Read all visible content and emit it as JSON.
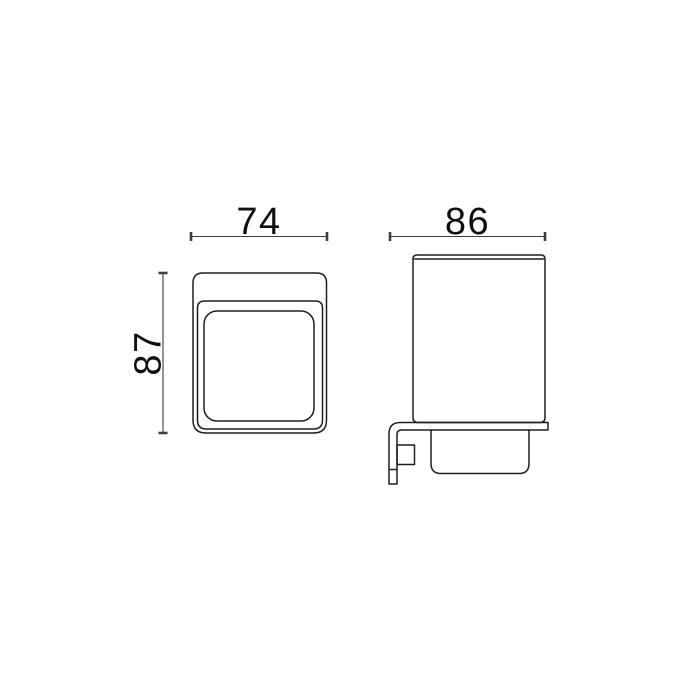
{
  "drawing": {
    "background_color": "#ffffff",
    "line_color": "#1e1e1e",
    "dimension_line_color": "#3d3d3d",
    "text_color": "#0f0f0f",
    "dimensions": {
      "front_width": "74",
      "front_height": "87",
      "side_depth": "86"
    }
  }
}
